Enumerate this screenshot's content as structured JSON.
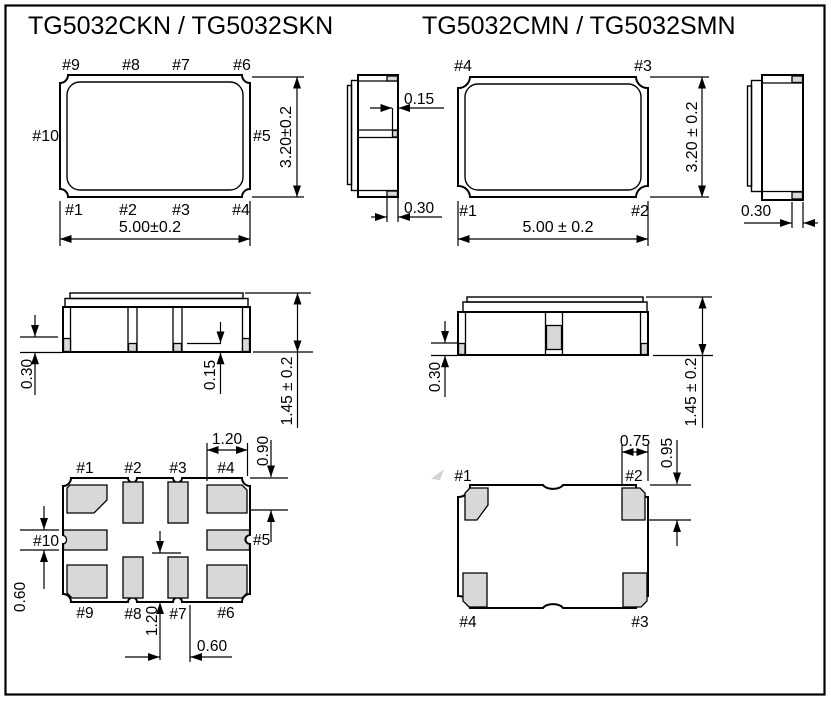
{
  "drawing": {
    "titles": {
      "left": "TG5032CKN / TG5032SKN",
      "right": "TG5032CMN / TG5032SMN"
    },
    "colors": {
      "line": "#000000",
      "pad_fill": "#d8d8d8",
      "background": "#ffffff"
    },
    "left_package": {
      "top_view": {
        "pins_top": [
          "#9",
          "#8",
          "#7",
          "#6"
        ],
        "pins_bottom": [
          "#1",
          "#2",
          "#3",
          "#4"
        ],
        "pin_left": "#10",
        "pin_right": "#5",
        "width_dim": "5.00±0.2",
        "height_dim": "3.20±0.2"
      },
      "side_view": {
        "pad_inset_dim": "0.15",
        "pad_width_dim": "0.30"
      },
      "front_view": {
        "pad_height_dim": "0.30",
        "center_pad_dim": "0.15",
        "body_height_dim": "1.45 ± 0.2"
      },
      "bottom_view": {
        "pins_top": [
          "#1",
          "#2",
          "#3",
          "#4"
        ],
        "pins_bottom": [
          "#9",
          "#8",
          "#7",
          "#6"
        ],
        "pin_left": "#10",
        "pin_right": "#5",
        "corner_pad_width_dim": "1.20",
        "corner_pad_length_dim": "0.90",
        "side_pad_width_dim": "0.60",
        "center_pad_length_dim": "1.20",
        "center_pad_width_dim": "0.60"
      }
    },
    "right_package": {
      "top_view": {
        "pin_top_left": "#4",
        "pin_top_right": "#3",
        "pin_bottom_left": "#1",
        "pin_bottom_right": "#2",
        "width_dim": "5.00 ± 0.2",
        "height_dim": "3.20 ± 0.2"
      },
      "side_view": {
        "pad_width_dim": "0.30"
      },
      "front_view": {
        "pad_height_dim": "0.30",
        "body_height_dim": "1.45 ± 0.2"
      },
      "bottom_view": {
        "pin_top_left": "#1",
        "pin_top_right": "#2",
        "pin_bottom_left": "#4",
        "pin_bottom_right": "#3",
        "pad_width_dim": "0.75",
        "pad_length_dim": "0.95"
      }
    }
  }
}
